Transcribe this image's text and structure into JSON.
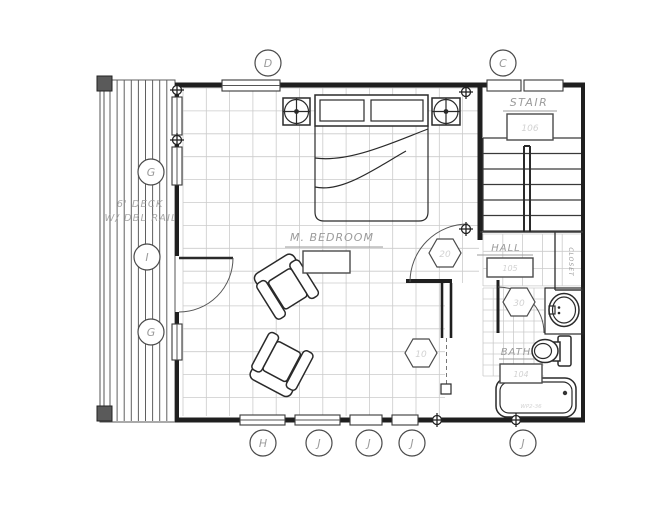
{
  "plan": {
    "rooms": {
      "bedroom": {
        "label": "M. BEDROOM",
        "number": ""
      },
      "stair": {
        "label": "STAIR",
        "number": "106"
      },
      "hall": {
        "label": "HALL",
        "number": "105"
      },
      "bath": {
        "label": "BATH",
        "number": "104"
      },
      "closet": {
        "label": "CLOSET"
      },
      "deck": {
        "label_line1": "6' DECK",
        "label_line2": "W/ DBL RAIL"
      }
    },
    "tags": {
      "grid_bubbles_top": [
        "D",
        "C"
      ],
      "grid_bubbles_left": [
        "G",
        "I",
        "G"
      ],
      "grid_bubbles_bottom": [
        "H",
        "J",
        "J",
        "J",
        "J"
      ],
      "hex_keynotes": [
        "20",
        "30",
        "10"
      ]
    },
    "notes": {
      "tub": "WP2-36"
    },
    "fixtures": [
      "bed",
      "ceiling-fan",
      "ceiling-fan",
      "armchair",
      "armchair",
      "sink",
      "toilet",
      "bathtub",
      "stair-treads",
      "door-swings"
    ],
    "colors": {
      "wall": "#1f1f1f",
      "line": "#3a3a3a",
      "grid": "#cbcbcb",
      "annotation": "#9b9b9b"
    }
  }
}
